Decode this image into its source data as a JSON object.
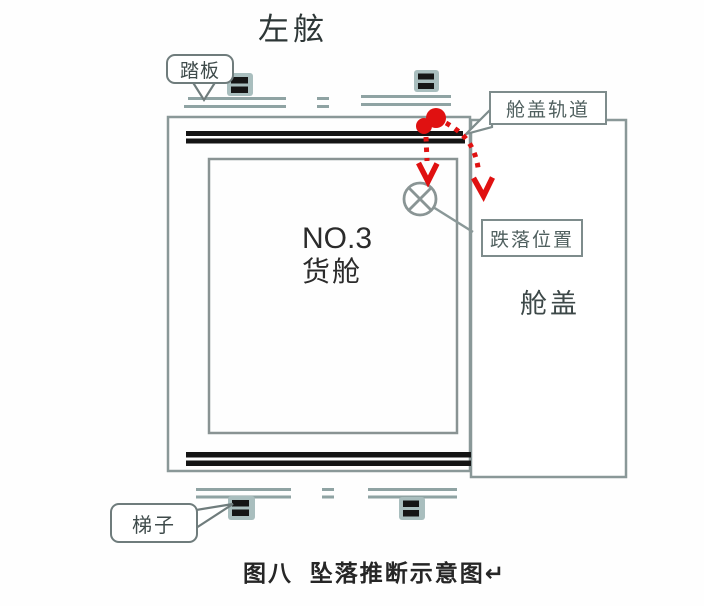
{
  "figure": {
    "orientation_label": "左舷",
    "cargo_hold": {
      "line1": "NO.3",
      "line2": "货舱"
    },
    "hatch_cover_label": "舱盖",
    "callouts": {
      "pedal": "踏板",
      "hatch_rail": "舱盖轨道",
      "fall_position": "跌落位置",
      "ladder": "梯子"
    },
    "caption": "图八  坠落推断示意图↵",
    "colors": {
      "diagram_line_gray": "#8a9898",
      "rail_black": "#141414",
      "trajectory_red": "#e01111"
    }
  }
}
